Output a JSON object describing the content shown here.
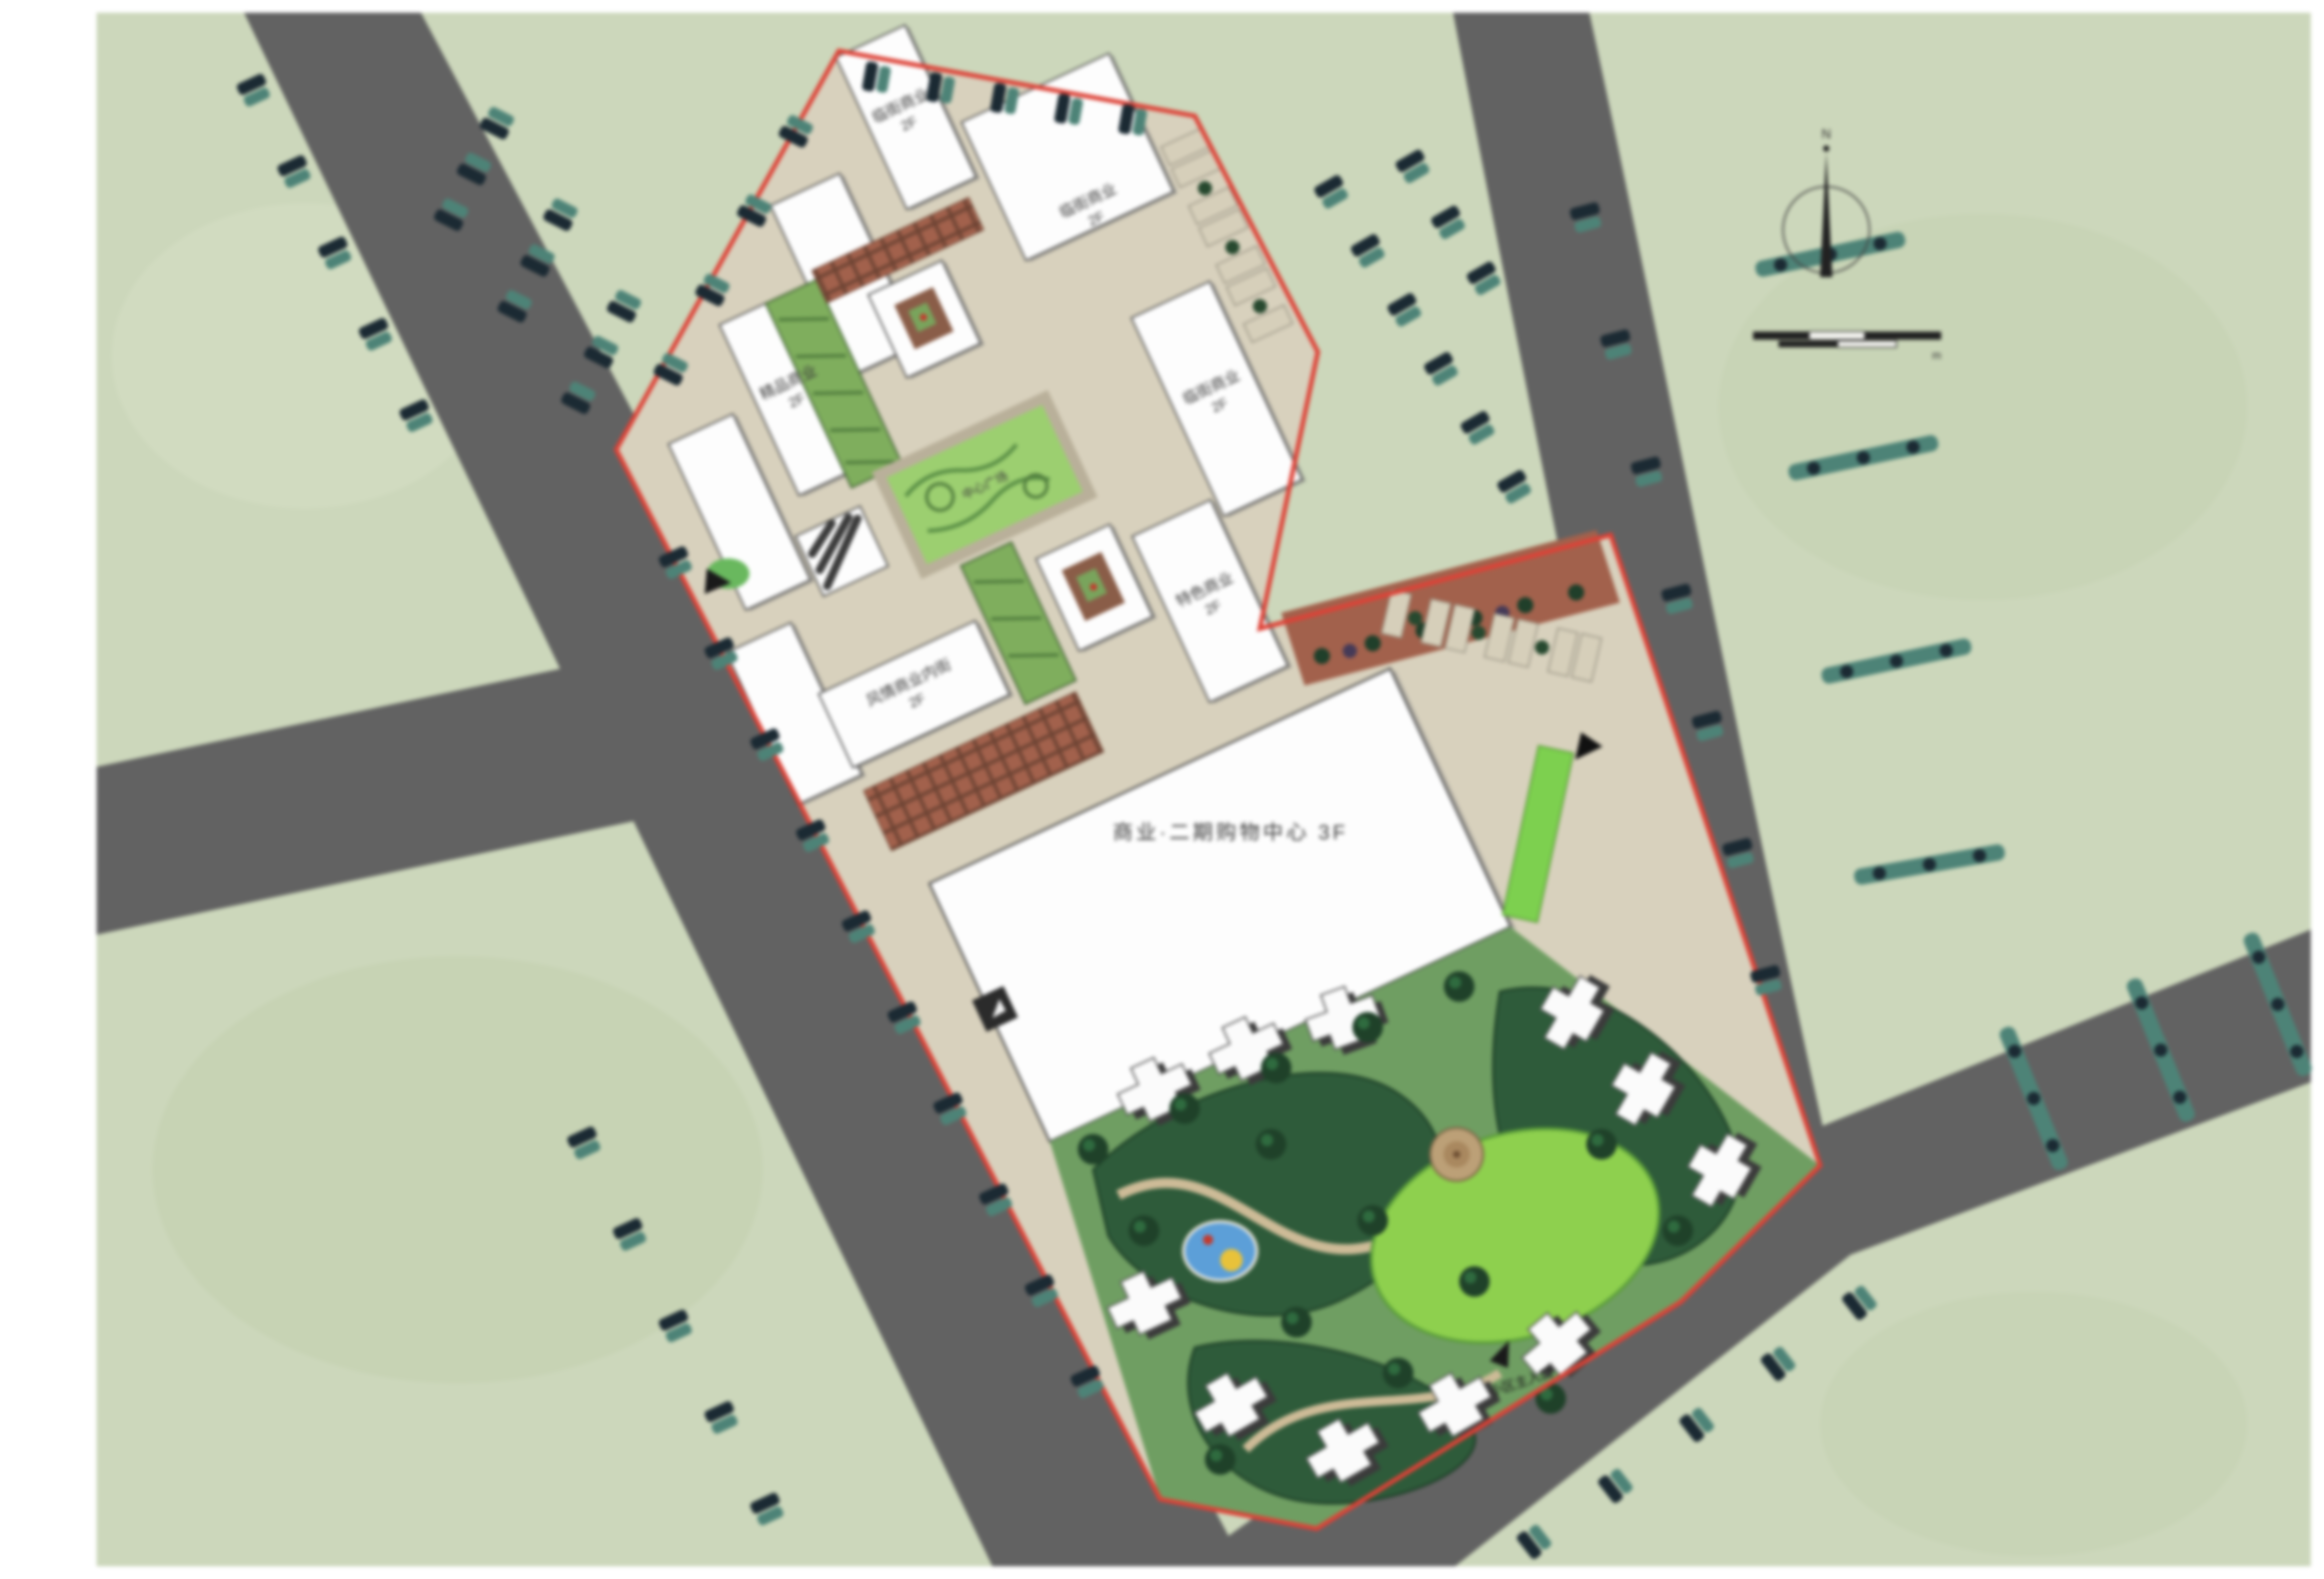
{
  "title": "residential-commercial master plan rendering",
  "colors": {
    "paper": "#ffffff",
    "ground_green": "#ccd7bb",
    "road_gray": "#626262",
    "boundary_red": "#dd4237",
    "paving_beige": "#d8d1bd",
    "brick": "#a2614c",
    "building_white": "#fdfdfd",
    "lawn_green": "#9ccf70",
    "bright_lawn": "#8ed04e",
    "garden_dark": "#2e5b3a",
    "pool_blue": "#5c9fd8",
    "street_tree_dark": "#1b2a33",
    "street_tree_teal": "#4d8377"
  },
  "north": {
    "label": "N"
  },
  "scale": {
    "unit": "m"
  },
  "buildings": [
    {
      "name": "临街商业",
      "floors": "2F"
    },
    {
      "name": "临街商业",
      "floors": "2F"
    },
    {
      "name": "风情商业内街",
      "floors": "2F"
    },
    {
      "name": "特色商业",
      "floors": "2F"
    },
    {
      "name": "临街商业",
      "floors": "2F"
    },
    {
      "name": "精品商业",
      "floors": "2F"
    }
  ],
  "anchor": {
    "label": "商业·二期购物中心 3F"
  },
  "plaza": {
    "label": "中心广场"
  },
  "entrances": {
    "main_label": "小区主入口"
  }
}
